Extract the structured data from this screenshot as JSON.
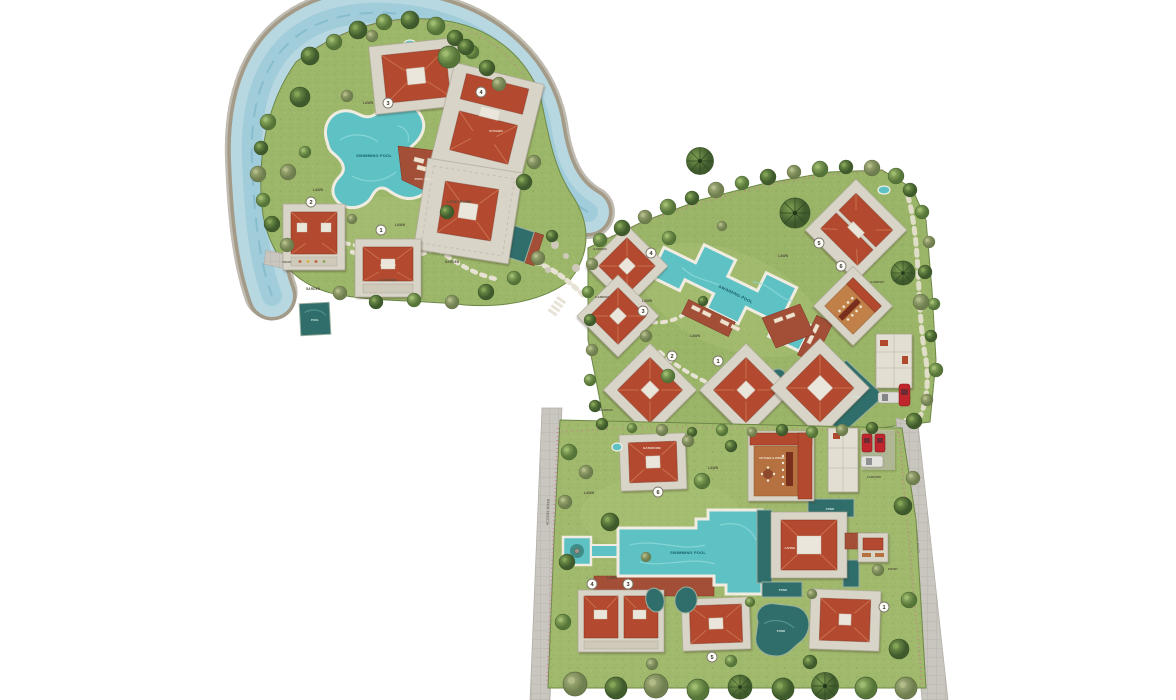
{
  "app": {
    "kind": "resort master site plan",
    "background": "#ffffff"
  },
  "palette": {
    "river": "#b7d7e1",
    "river_deep": "#8fc2d3",
    "grass": "#9cb76a",
    "pool_water": "#5ec2c5",
    "pond_water": "#2f6e6b",
    "roof": "#b34a2e",
    "terrace": "#d9d4c8",
    "deck_wood": "#a34e37",
    "deck_orange": "#c08046",
    "road": "#c9c6c0",
    "car_red": "#c0272d",
    "car_white": "#e4e2dc"
  },
  "estates": {
    "west": {
      "labels": {
        "swimming_pool": "SWIMMING POOL",
        "pool_deck": "POOL DECK",
        "living_room": "LIVING ROOM",
        "bedroom": "BEDROOM",
        "bathroom": "BATHROOM",
        "kitchen": "KITCHEN",
        "lawn": "LAWN",
        "garden": "GARDEN",
        "road": "ROAD",
        "pool": "POOL"
      },
      "markers": [
        "1",
        "2",
        "3",
        "4"
      ]
    },
    "central": {
      "labels": {
        "swimming_pool": "SWIMMING POOL",
        "lawn": "LAWN",
        "garden": "GARDEN",
        "pond": "POND"
      },
      "markers": [
        "1",
        "2",
        "3",
        "4",
        "5",
        "6"
      ]
    },
    "south": {
      "labels": {
        "swimming_pool": "SWIMMING POOL",
        "bathroom": "BATHROOM",
        "kitchen_dining": "KITCHEN & DINING",
        "living": "LIVING",
        "pond": "POND",
        "lawn": "LAWN",
        "entry": "ENTRY",
        "carpark": "CARPARK",
        "access_road": "ACCESS ROAD"
      },
      "markers": [
        "1",
        "3",
        "4",
        "5",
        "6"
      ]
    }
  }
}
